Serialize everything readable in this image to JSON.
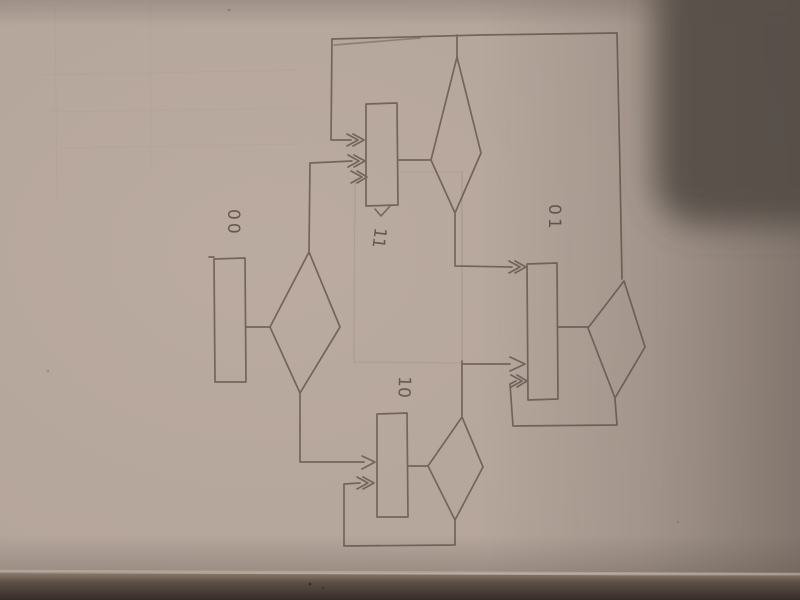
{
  "diagram": {
    "nodes": {
      "state_left": {
        "label": "00"
      },
      "state_top_middle": {
        "label": "11"
      },
      "state_right": {
        "label": "01"
      },
      "state_bottom_middle": {
        "label": "10"
      }
    }
  },
  "colors": {
    "paper": "#b4a59b",
    "paper_light": "#c0b0a5",
    "pencil": "#6d6057",
    "faint_pencil": "#a3958a",
    "label_ink": "#5f544b",
    "shadow_blob": "#534b45",
    "bottom_strip": "#3e352f",
    "fold_highlight": "#c6b6a9"
  }
}
